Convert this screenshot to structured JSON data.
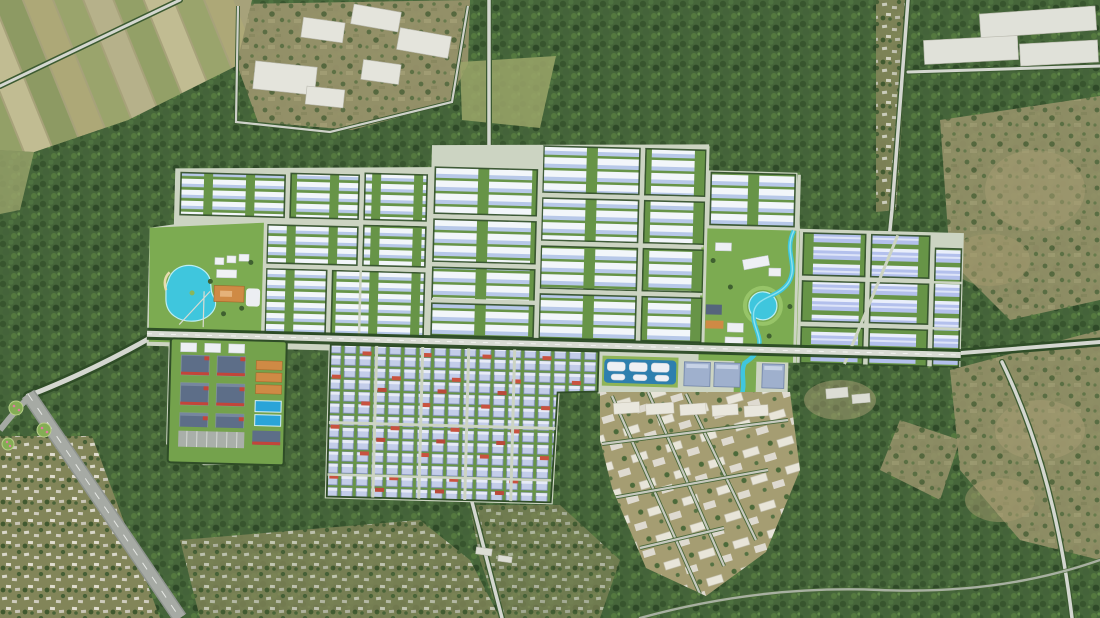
{
  "scene": {
    "type": "aerial-3d-masterplan-render",
    "description": "Aerial rendering of a large gridded industrial park masterplan with white and pale-blue roofed warehouses, a turquoise lake park on the west, a winding river park on the east, a tree-lined central boulevard, a ready-built factory district, dense small-unit grids, an existing tan town grid to the southeast, farm fields northwest, villages and forest all around, and a gray highway in the southwest corner",
    "features": [
      "forest-terrain",
      "farm-fields-northwest",
      "factory-cluster-north",
      "warehouses-northeast",
      "industrial-park-blocks",
      "west-lake-park",
      "east-river-park",
      "central-boulevard",
      "ready-built-district-southwest",
      "dense-smallunit-grid-south",
      "amenity-pools-cluster",
      "east-warehouse-grid",
      "town-grid-southeast",
      "highway-southwest",
      "villages"
    ]
  },
  "palette": {
    "forest": "#46663a",
    "forestDark": "#35512c",
    "scrub": "#97926a",
    "fieldLight": "#b5b088",
    "tan": "#ab9f74",
    "roadLight": "#d4d7d0",
    "roadGray": "#a6aaa4",
    "parkGreen": "#7cab51",
    "blockGreen": "#679447",
    "roofWhite": "#f2f6fa",
    "roofBlue": "#b7c8e8",
    "roofPeriwinkle": "#b3c0ec",
    "roofSlate": "#5d6e88",
    "accentRed": "#c2453a",
    "accentOrange": "#cf8a45",
    "water": "#3fc6dd",
    "treeLine": "#2f4d27",
    "townTan": "#a59d72",
    "buildingWhite": "#e4e4dc",
    "parkBase": "#ccd4c2"
  }
}
